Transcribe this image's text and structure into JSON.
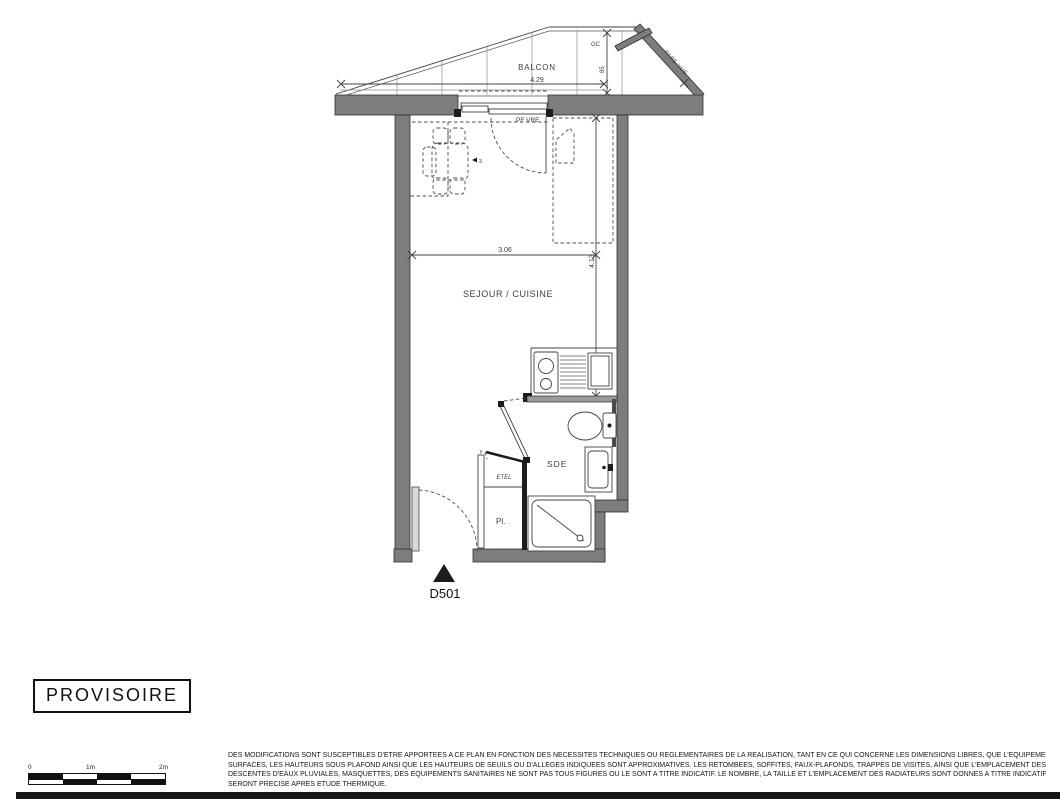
{
  "plan": {
    "unit": "D501",
    "rooms": {
      "balcony": "BALCON",
      "living": "SEJOUR / CUISINE",
      "shower_room": "SDE",
      "closet": "Pl.",
      "technical": "ETEL"
    },
    "labels": {
      "gutter": "GC",
      "window": "PF VRE",
      "privacy_screen": "PARE-VUE",
      "table_tag": "3"
    },
    "dimensions": {
      "balcony_length": "4.29",
      "balcony_depth": "85",
      "living_width": "3.06",
      "living_length": "4.13"
    }
  },
  "stamp": {
    "text": "PROVISOIRE"
  },
  "scale_bar": {
    "zero": "0",
    "one": "1m",
    "two": "2m"
  },
  "disclaimer": {
    "lines": [
      "DES MODIFICATIONS SONT SUSCEPTIBLES D'ETRE APPORTEES A CE PLAN EN FONCTION DES NECESSITES TECHNIQUES OU REGLEMENTAIRES DE LA REALISATION, TANT EN CE QUI CONCERNE LES DIMENSIONS LIBRES, QUE L'EQUIPEMENT. LES",
      "SURFACES, LES HAUTEURS SOUS PLAFOND AINSI QUE LES HAUTEURS DE SEUILS OU D'ALLEGES INDIQUEES SONT APPROXIMATIVES. LES RETOMBEES, SOFFITES, FAUX-PLAFONDS, TRAPPES DE VISITES, AINSI QUE L'EMPLACEMENT DES",
      "DESCENTES D'EAUX PLUVIALES, MASQUETTES, DES EQUIPEMENTS SANITAIRES NE SONT PAS TOUS FIGURES OU LE SONT A TITRE INDICATIF. LE NOMBRE, LA TAILLE ET L'EMPLACEMENT DES RADIATEURS SONT DONNES A TITRE INDICATIF ET",
      "SERONT PRECISE APRES ETUDE THERMIQUE."
    ]
  },
  "colors": {
    "wall_fill": "#7d7d7d",
    "plan_line": "#3f4348",
    "plan_text": "#3a4148",
    "black": "#1c1c1c"
  }
}
